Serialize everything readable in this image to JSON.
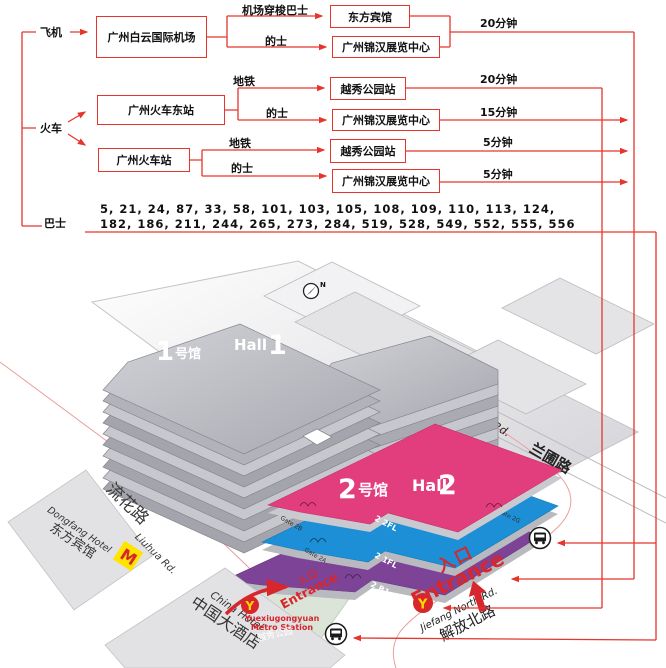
{
  "flowchart": {
    "src_plane": "飞机",
    "src_train": "火车",
    "src_bus": "巴士",
    "airport": "广州白云国际机场",
    "east_station": "广州火车东站",
    "station": "广州火车站",
    "dongfang_hotel": "东方宾馆",
    "jinhan_a": "广州锦汉展览中心",
    "jinhan_b": "广州锦汉展览中心",
    "jinhan_c": "广州锦汉展览中心",
    "yuexiu_a": "越秀公园站",
    "yuexiu_b": "越秀公园站",
    "shuttle": "机场穿梭巴士",
    "taxi_a": "的士",
    "taxi_b": "的士",
    "taxi_c": "的士",
    "metro_a": "地铁",
    "metro_b": "地铁",
    "d20a": "20分钟",
    "d20b": "20分钟",
    "d15": "15分钟",
    "d5a": "5分钟",
    "d5b": "5分钟",
    "bus_line1": "5, 21, 24, 87, 33, 58, 101, 103, 105, 108, 109, 110, 113, 124,",
    "bus_line2": "182, 186, 211, 244, 265, 273, 284, 519, 528, 549, 552, 555, 556"
  },
  "map": {
    "compass_n": "N",
    "hall1": {
      "num": "1",
      "cn": "号馆",
      "en": "Hall",
      "en_num": "1"
    },
    "hall2": {
      "num": "2",
      "cn": "号馆",
      "en": "Hall",
      "en_num": "2"
    },
    "floors": {
      "f2": "2 2FL",
      "f1": "2 1FL",
      "b1": "2 B1"
    },
    "gates": {
      "g2b": "Gate 2B",
      "g2a": "Gate 2A",
      "g2g": "Gate 2G",
      "g2h": "Gate 2H"
    },
    "roads": {
      "liuhua_cn": "流花路",
      "liuhua_en": "Liuhua Rd.",
      "lanpu_en": "Lan Pu Rd.",
      "lanpu_cn": "兰圃路",
      "jiefang_en": "Jiefang North Rd.",
      "jiefang_cn": "解放北路"
    },
    "places": {
      "dongfang_en": "Dongfang Hotel",
      "dongfang_cn": "东方宾馆",
      "china_en": "China Hotel",
      "china_cn": "中国大酒店",
      "mcdonalds": "M",
      "metro_logo": "Y",
      "metro_en1": "Yuexiugongyuan",
      "metro_en2": "Metro Station",
      "park_cn": "越秀公园"
    },
    "entrance_left": {
      "cn": "入口",
      "en": "Entrance"
    },
    "entrance_right": {
      "cn": "入口",
      "en": "Entrance"
    }
  },
  "colors": {
    "route_red": "#E5352C",
    "entrance_red": "#D7262C",
    "hall2_pink": "#E23E7E",
    "hall2_blue": "#1C8FD6",
    "hall2_purple": "#7D4397",
    "terrace_green": "#DAE5D8",
    "mcd_yellow": "#FFE400",
    "metro_yellow": "#FFD800",
    "block_gray": "#E4E4E7"
  }
}
